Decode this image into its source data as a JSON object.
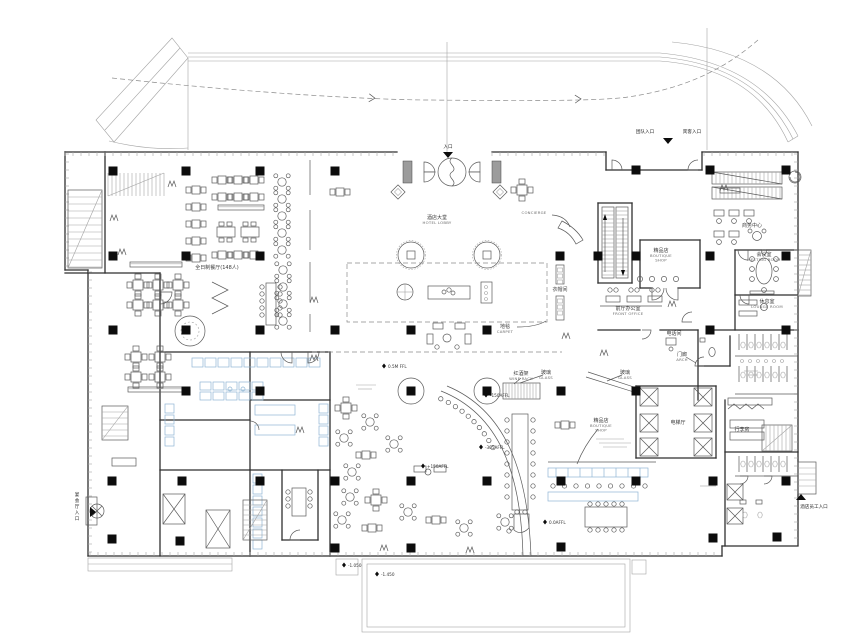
{
  "plan": {
    "colors": {
      "ink": "#2f2f2f",
      "mid": "#6f6f6f",
      "light": "#a3a3a3",
      "kitchen": "#8fb5d3",
      "column": "#0c0c0c",
      "paper": "#ffffff"
    },
    "rooms": [
      {
        "id": "hotel-lobby",
        "zh": "酒店大堂",
        "en": "HOTEL LOBBY",
        "x": 437,
        "y": 219
      },
      {
        "id": "all-day-dining",
        "zh": "全日制餐厅(148人)",
        "en": "",
        "x": 217,
        "y": 269
      },
      {
        "id": "concierge",
        "zh": "",
        "en": "CONCIERGE",
        "x": 534,
        "y": 214
      },
      {
        "id": "carpet",
        "zh": "地毯",
        "en": "CARPET",
        "x": 505,
        "y": 328
      },
      {
        "id": "wine-rack",
        "zh": "红酒架",
        "en": "WINE RACK",
        "x": 521,
        "y": 375
      },
      {
        "id": "boutique-shop",
        "zh": "精品店",
        "en": "BOUTIQUE SHOP",
        "x": 661,
        "y": 252
      },
      {
        "id": "front-office",
        "zh": "前厅办公室",
        "en": "FRONT OFFICE",
        "x": 628,
        "y": 310
      },
      {
        "id": "business-centre",
        "zh": "商务中心",
        "en": "",
        "x": 752,
        "y": 227
      },
      {
        "id": "meeting-room",
        "zh": "会议室",
        "en": "MEETING ROOM",
        "x": 764,
        "y": 256
      },
      {
        "id": "lounge-room",
        "zh": "休息室",
        "en": "LOUNGE ROOM",
        "x": 767,
        "y": 303
      },
      {
        "id": "telephone-room",
        "zh": "电话间",
        "en": "",
        "x": 674,
        "y": 335
      },
      {
        "id": "porch",
        "zh": "门廊",
        "en": "ARCH",
        "x": 682,
        "y": 356
      },
      {
        "id": "glass-screen-west",
        "zh": "玻璃",
        "en": "GLASS",
        "x": 546,
        "y": 374
      },
      {
        "id": "glass-screen-east",
        "zh": "玻璃",
        "en": "GLASS",
        "x": 625,
        "y": 374
      },
      {
        "id": "bakery-boutique",
        "zh": "精品店",
        "en": "BOUTIQUE SHOP",
        "x": 601,
        "y": 422
      },
      {
        "id": "lift-lobby",
        "zh": "电梯厅",
        "en": "",
        "x": 678,
        "y": 424
      },
      {
        "id": "luggage-room",
        "zh": "行李房",
        "en": "",
        "x": 742,
        "y": 431
      },
      {
        "id": "cloak-room",
        "zh": "衣帽间",
        "en": "",
        "x": 560,
        "y": 291
      }
    ],
    "elevations": [
      {
        "text": "0.5M FFL",
        "x": 390,
        "y": 368
      },
      {
        "text": "-150AFFL",
        "x": 492,
        "y": 397
      },
      {
        "text": "-305AFFL",
        "x": 487,
        "y": 449
      },
      {
        "text": "+150AFFL",
        "x": 429,
        "y": 468
      },
      {
        "text": "0.0AFFL",
        "x": 551,
        "y": 524
      },
      {
        "text": "-1.450",
        "x": 383,
        "y": 576
      },
      {
        "text": "-1.050",
        "x": 350,
        "y": 567
      }
    ],
    "entrances": [
      {
        "id": "main-entrance",
        "label": "入口",
        "x": 448,
        "y": 148,
        "tri": "down",
        "tx": 448,
        "ty": 152
      },
      {
        "id": "group-entrance",
        "label": "团队入口",
        "x": 645,
        "y": 133
      },
      {
        "id": "guest-entrance",
        "label": "宾客入口",
        "x": 692,
        "y": 133,
        "tri": "down",
        "tx": 668,
        "ty": 138
      },
      {
        "id": "banquet-entrance",
        "label": "宴会厅入口",
        "x": 77,
        "y": 496,
        "vertical": true,
        "tri": "right",
        "tx": 90,
        "ty": 512
      },
      {
        "id": "staff-entrance",
        "label": "酒店员工入口",
        "x": 814,
        "y": 508,
        "tri": "up",
        "tx": 801,
        "ty": 500
      }
    ]
  }
}
